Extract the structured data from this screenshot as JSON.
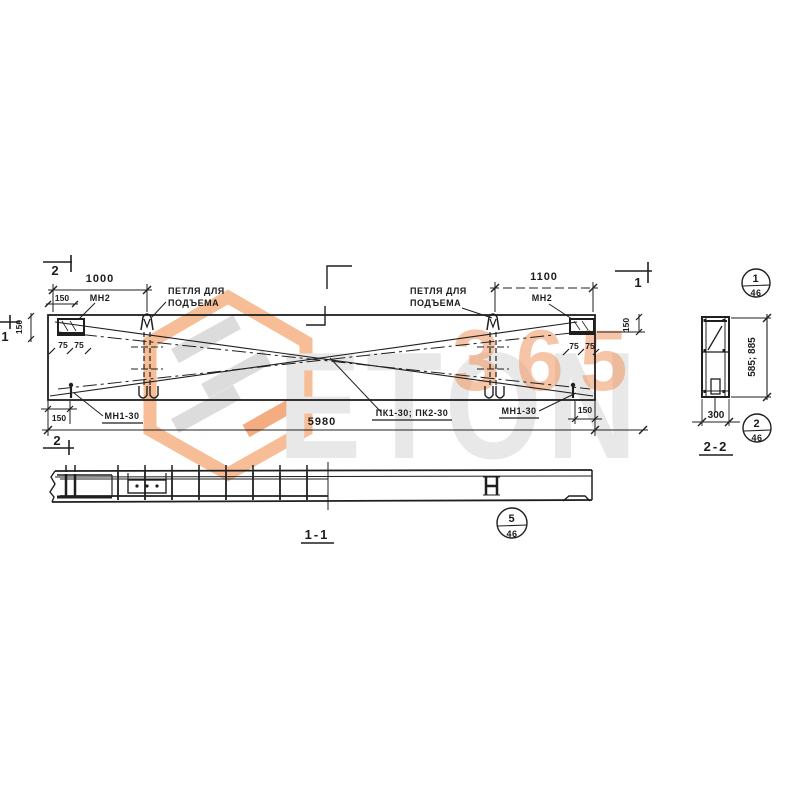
{
  "watermark": {
    "brand": "ETON",
    "number": "365"
  },
  "colors": {
    "ink": "#1f1f1f",
    "orange_accent": "#ee945c",
    "logo_outline": "#f6bd96",
    "logo_bar_gray": "#dcdcdc",
    "logo_bar_orange": "#f3ad80",
    "watermark_gray": "#e8e8e8"
  },
  "plan": {
    "section_marks": {
      "cut2": "2",
      "cut1": "1"
    },
    "dims": {
      "span_left": "1000",
      "span_right": "1100",
      "edge_offset": "150",
      "plate_half": "75",
      "side_offset": "150",
      "bottom_offset": "150",
      "total_length": "5980"
    },
    "labels": {
      "embed_plate": "МН2",
      "loop_line1": "ПЕТЛЯ ДЛЯ",
      "loop_line2": "ПОДЪЕМА",
      "anchor": "МН1-30",
      "panel_marks": "ПК1-30; ПК2-30"
    }
  },
  "section22": {
    "title": "2-2",
    "dim_width": "300",
    "dim_height": "585; 885",
    "callout_top": {
      "num": "1",
      "den": "46"
    },
    "callout_bottom": {
      "num": "2",
      "den": "46"
    }
  },
  "section11": {
    "title": "1-1",
    "callout": {
      "num": "5",
      "den": "46"
    }
  }
}
